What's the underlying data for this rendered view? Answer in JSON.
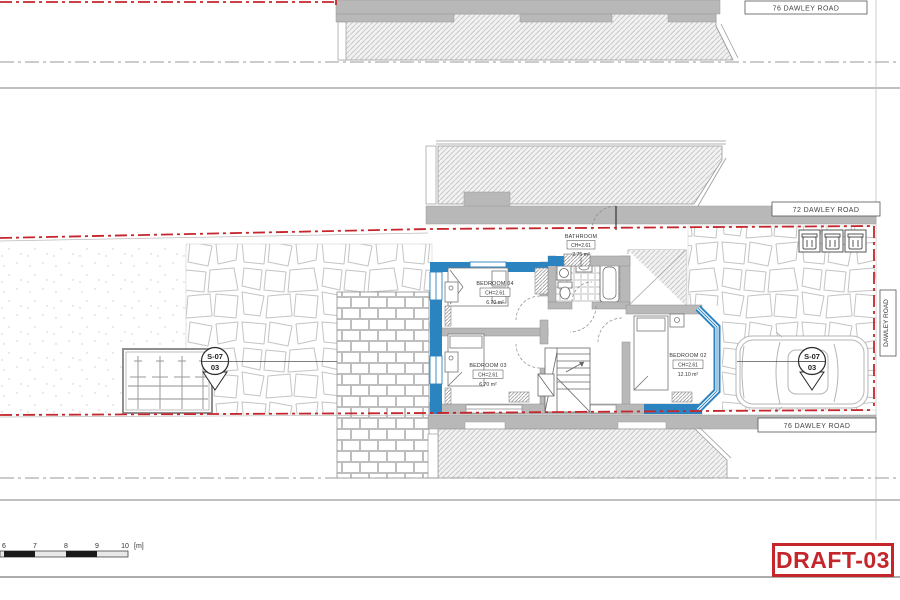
{
  "road_labels": {
    "top": "76 DAWLEY ROAD",
    "middle": "72 DAWLEY ROAD",
    "bottom": "76 DAWLEY ROAD",
    "side": "DAWLEY ROAD"
  },
  "rooms": {
    "bedroom04": {
      "name": "BEDROOM 04",
      "ch": "CH=2.61",
      "area": "6.70 m²"
    },
    "bedroom03": {
      "name": "BEDROOM 03",
      "ch": "CH=2.61",
      "area": "6.70 m²"
    },
    "bedroom02": {
      "name": "BEDROOM 02",
      "ch": "CH=2.61",
      "area": "12.10 m²"
    },
    "bathroom": {
      "name": "BATHROOM",
      "ch": "CH=2.61",
      "area": "2.75 m²"
    }
  },
  "section_markers": {
    "left": {
      "code": "S-07",
      "sheet": "03"
    },
    "right": {
      "code": "S-07",
      "sheet": "03"
    }
  },
  "scale_bar": {
    "ticks": [
      "6",
      "7",
      "8",
      "9",
      "10"
    ],
    "unit": "[m]"
  },
  "stamp": {
    "label": "DRAFT-03"
  },
  "colors": {
    "boundary_red": "#c5262c",
    "wall_blue": "#2b83c0",
    "wall_gray": "#b8b8b8",
    "draft_red": "#c5262c"
  }
}
